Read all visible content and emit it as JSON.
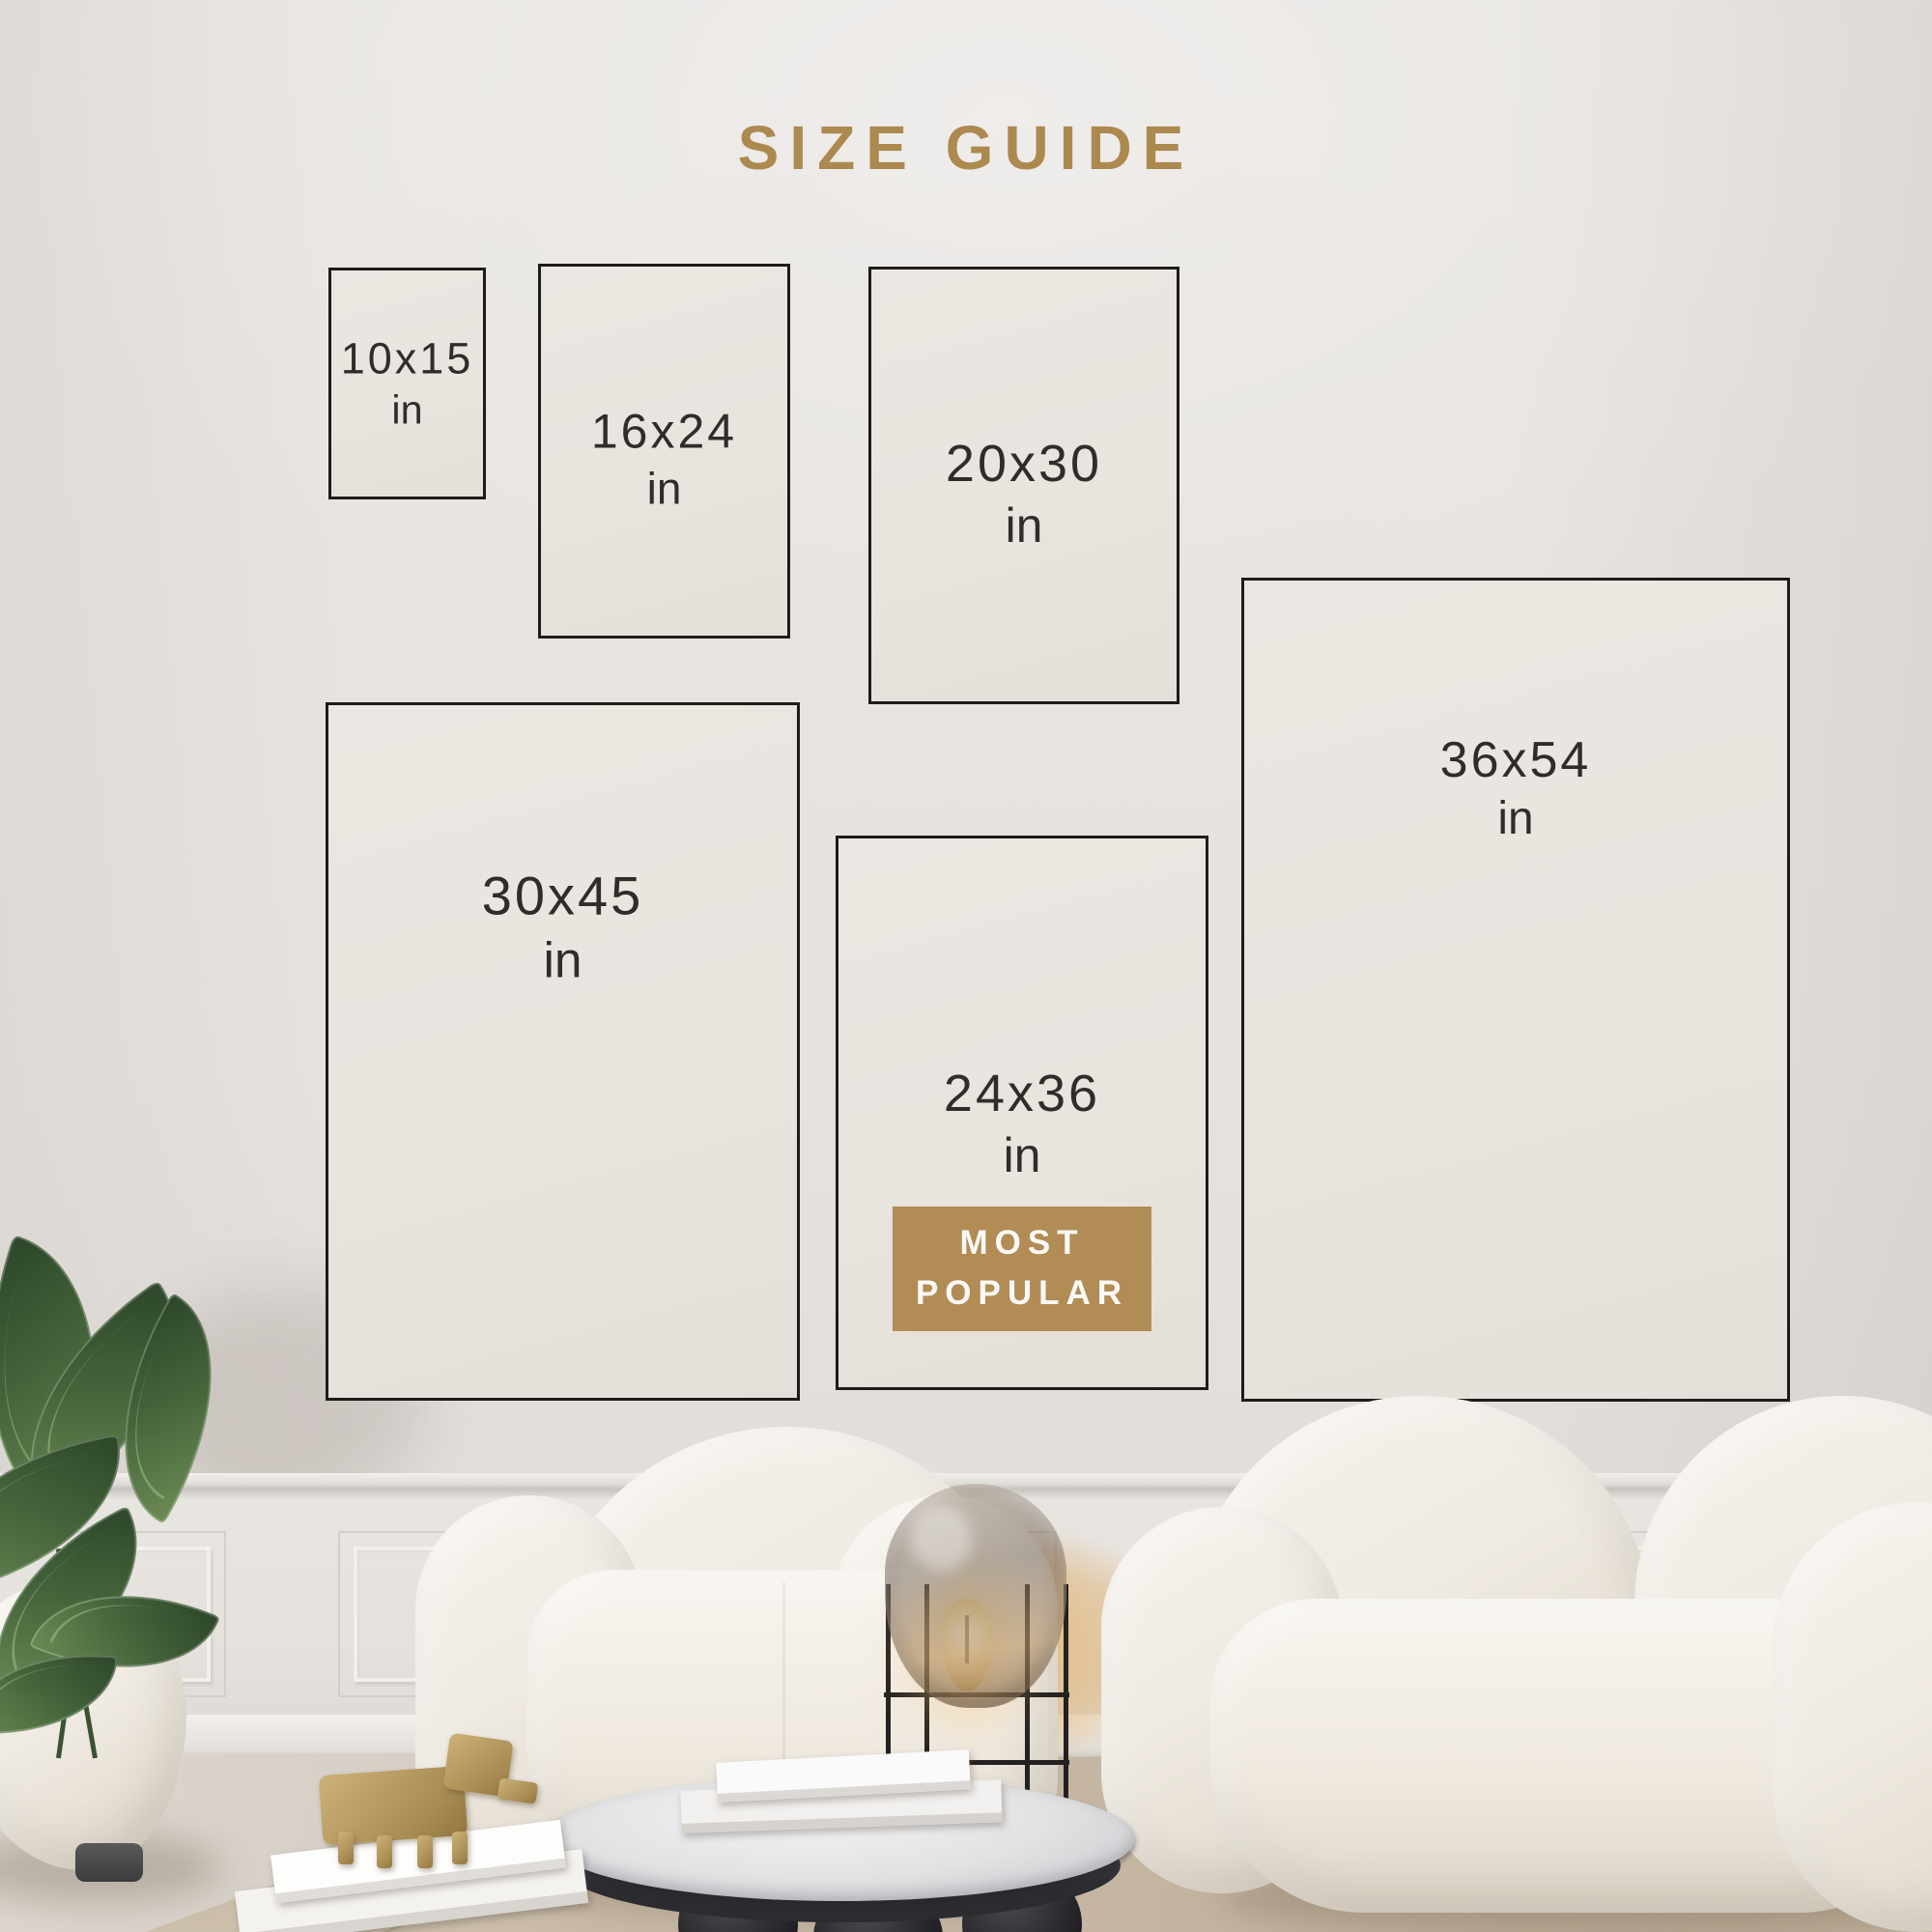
{
  "title": "SIZE GUIDE",
  "boxes": [
    {
      "size": "10x15",
      "unit": "in"
    },
    {
      "size": "16x24",
      "unit": "in"
    },
    {
      "size": "20x30",
      "unit": "in"
    },
    {
      "size": "30x45",
      "unit": "in"
    },
    {
      "size": "24x36",
      "unit": "in",
      "badge": "MOST POPULAR"
    },
    {
      "size": "36x54",
      "unit": "in"
    }
  ],
  "badge": {
    "line1": "MOST",
    "line2": "POPULAR"
  },
  "colors": {
    "accent_gold": "#ac894f",
    "badge_gold": "#b28c55",
    "badge_text": "#fbf9f6",
    "box_border": "#1d1c1a",
    "label_text": "#2e2d2b",
    "wall": "#e6e2df",
    "rug": "#c6b8a4"
  }
}
